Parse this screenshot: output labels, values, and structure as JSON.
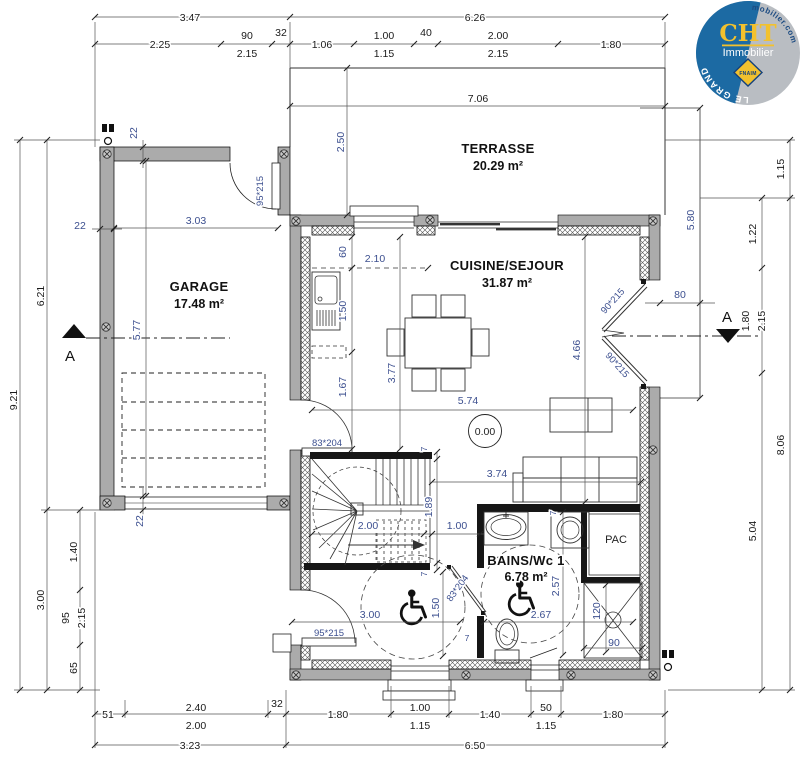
{
  "colors": {
    "accent_dim": "#3c4f8f",
    "wall_gray": "#ababab",
    "partition_black": "#161616",
    "logo_blue": "#1c6aa3",
    "logo_gray": "#b9bdc2",
    "logo_yellow": "#f2c12e"
  },
  "logo": {
    "brand": "CHT",
    "subtitle": "Immobilier",
    "badge": "FNAIM",
    "left_text": "PLELAN LE GRAND",
    "right_text": "www.cht-immobilier.com"
  },
  "rooms": {
    "terrasse": {
      "name": "TERRASSE",
      "area": "20.29 m²"
    },
    "garage": {
      "name": "GARAGE",
      "area": "17.48 m²"
    },
    "cuisine": {
      "name": "CUISINE/SEJOUR",
      "area": "31.87 m²"
    },
    "bains": {
      "name": "BAINS/Wc 1",
      "area": "6.78 m²"
    },
    "pac": "PAC"
  },
  "level": "0.00",
  "section": {
    "label": "A"
  },
  "doors": {
    "garage": "95*215",
    "entry": "95*215",
    "inner": "83*204",
    "bath": "83*204",
    "french1": "90*215",
    "french2": "90*215"
  },
  "d": {
    "top1_a": "3.47",
    "top1_b": "6.26",
    "top2_a": "2.25",
    "top2_b1": "90",
    "top2_b2": "2.15",
    "top2_c": "32",
    "top2_d": "1.06",
    "top2_e1": "1.00",
    "top2_e2": "1.15",
    "top2_f": "40",
    "top2_g1": "2.00",
    "top2_g2": "2.15",
    "top2_h": "1.80",
    "terrace_w": "7.06",
    "terrace_d": "2.50",
    "left_a": "9.21",
    "left_b": "6.21",
    "left_c": "3.00",
    "left_d": "22",
    "left_e": "1.40",
    "left_f1": "95",
    "left_f2": "2.15",
    "left_g": "65",
    "right_a": "1.15",
    "right_b": "1.22",
    "right_c1": "1.80",
    "right_c2": "2.15",
    "right_d": "8.06",
    "right_e": "5.04",
    "right_f": "5.80",
    "right_g": "80",
    "bot1_a": "51",
    "bot1_b1": "2.40",
    "bot1_b2": "2.00",
    "bot1_c": "32",
    "bot1_d": "1.80",
    "bot1_e1": "1.00",
    "bot1_e2": "1.15",
    "bot1_f": "1.40",
    "bot1_g1": "50",
    "bot1_g2": "1.15",
    "bot1_h": "1.80",
    "bot2_a": "3.23",
    "bot2_b": "6.50",
    "gar_w": "3.03",
    "gar_h": "5.77",
    "gar_t1": "22",
    "gar_t2": "22",
    "k_a": "60",
    "k_b": "2.10",
    "k_c": "1.50",
    "k_d": "1.67",
    "k_e": "3.77",
    "k_f": "4.66",
    "k_g": "5.74",
    "k_h": "3.74",
    "s_a": "2.00",
    "s_b": "1.89",
    "s_c": "1.00",
    "s_d": "3.00",
    "s_e": "1.50",
    "s_f": "7",
    "s_g": "7",
    "s_h": "7",
    "s_i": "7",
    "b_a": "2.57",
    "b_b": "2.67",
    "b_c": "120",
    "b_d": "90"
  }
}
